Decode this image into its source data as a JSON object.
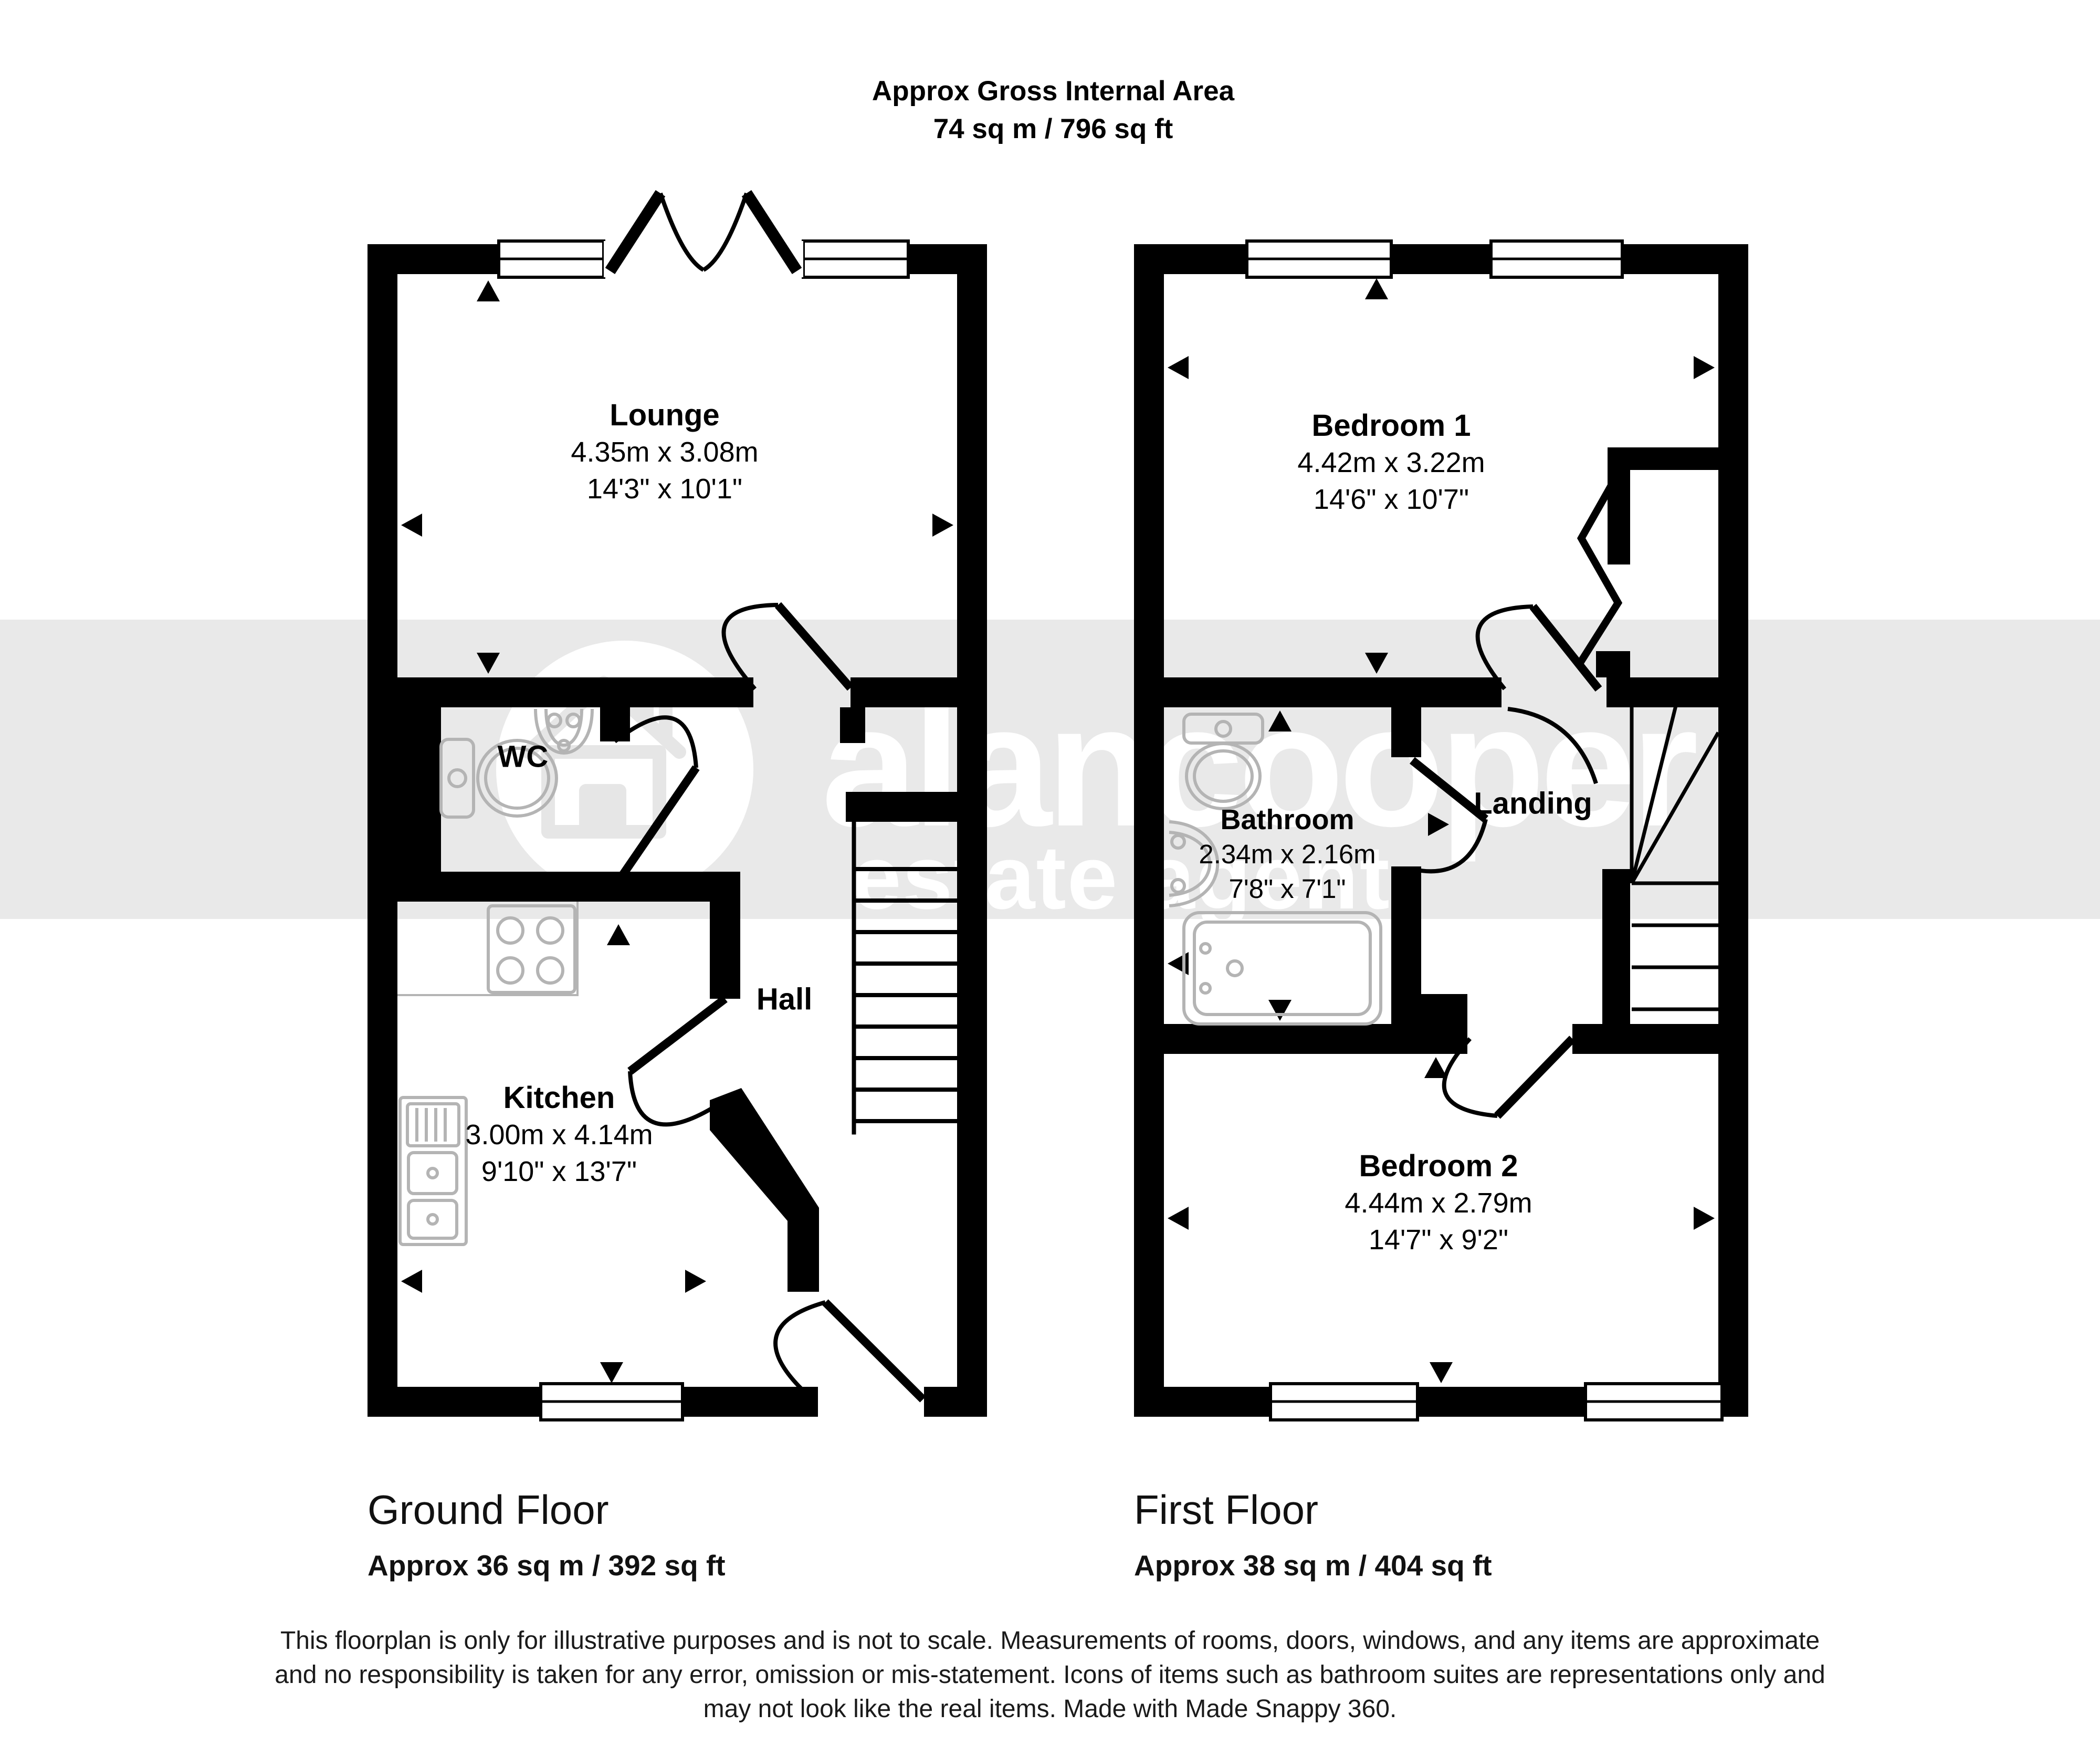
{
  "title": {
    "line1": "Approx Gross Internal Area",
    "line2": "74 sq m / 796 sq ft"
  },
  "watermark": {
    "brand": "alancooper",
    "tagline": "estate agent"
  },
  "ground_floor": {
    "label": "Ground Floor",
    "area": "Approx 36 sq m / 392 sq ft",
    "rooms": {
      "lounge": {
        "name": "Lounge",
        "metric": "4.35m x 3.08m",
        "imperial": "14'3\" x 10'1\""
      },
      "wc": {
        "name": "WC"
      },
      "hall": {
        "name": "Hall"
      },
      "kitchen": {
        "name": "Kitchen",
        "metric": "3.00m x 4.14m",
        "imperial": "9'10\" x 13'7\""
      }
    }
  },
  "first_floor": {
    "label": "First Floor",
    "area": "Approx 38 sq m / 404 sq ft",
    "rooms": {
      "bedroom1": {
        "name": "Bedroom 1",
        "metric": "4.42m x 3.22m",
        "imperial": "14'6\" x 10'7\""
      },
      "bathroom": {
        "name": "Bathroom",
        "metric": "2.34m x 2.16m",
        "imperial": "7'8\" x 7'1\""
      },
      "landing": {
        "name": "Landing"
      },
      "bedroom2": {
        "name": "Bedroom 2",
        "metric": "4.44m x 2.79m",
        "imperial": "14'7\" x 9'2\""
      }
    }
  },
  "disclaimer": {
    "line1": "This floorplan is only for illustrative purposes and is not to scale. Measurements of rooms, doors, windows, and any items are approximate",
    "line2": "and no responsibility is taken for any error, omission or mis-statement. Icons of items such as bathroom suites are representations only and",
    "line3": "may not look like the real items. Made with Made Snappy 360."
  },
  "colors": {
    "wall": "#000000",
    "watermark_band": "#e9e9e9",
    "watermark_text": "#ffffff",
    "fixture_outline": "#b4b4b4",
    "label_text": "#000000"
  }
}
